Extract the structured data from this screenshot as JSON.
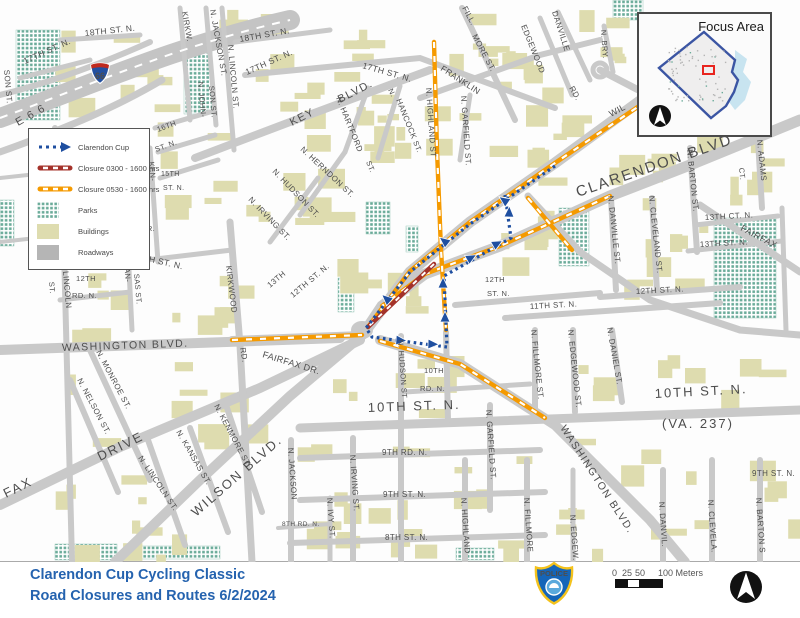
{
  "title_block": {
    "line1": "Clarendon Cup Cycling Classic",
    "line2": "Road Closures and Routes 6/2/2024"
  },
  "legend": {
    "items": [
      {
        "label": "Clarendon Cup"
      },
      {
        "label": "Closure 0300 - 1600 hrs"
      },
      {
        "label": "Closure 0530 - 1600 hrs"
      },
      {
        "label": "Parks"
      },
      {
        "label": "Buildings"
      },
      {
        "label": "Roadways"
      }
    ]
  },
  "inset": {
    "title": "Focus Area"
  },
  "scalebar": {
    "tick0": "0",
    "tick25": "25",
    "tick50": "50",
    "end_label": "100 Meters"
  },
  "badge": {
    "text": "POLICE"
  },
  "colors": {
    "route_blue": "#1f4fa0",
    "closure_0300": "#a4322a",
    "closure_0530": "#f59a00",
    "park_green": "#6aab99",
    "building_beige": "#dedcaf",
    "roadway_gray": "#b5b5b5",
    "title_blue": "#2563af"
  },
  "map": {
    "i66_shield": "66",
    "street_labels": [
      [
        "KIRKW.",
        182,
        12,
        80,
        8
      ],
      [
        "N. JACKSON ST.",
        210,
        10,
        80,
        8
      ],
      [
        "N. JOHN-",
        198,
        82,
        85,
        7.5
      ],
      [
        "SON ST.",
        209,
        86,
        85,
        7.5
      ],
      [
        "SON ST.",
        4,
        70,
        85,
        8
      ],
      [
        "18TH ST. N.",
        85,
        36,
        -6,
        8.5
      ],
      [
        "17TH ST. N.",
        25,
        64,
        -24,
        8.5
      ],
      [
        "18TH ST. N.",
        240,
        42,
        -10,
        8.5
      ],
      [
        "17TH ST. N.",
        247,
        75,
        -24,
        8.5
      ],
      [
        "17TH ST. N.",
        362,
        68,
        16,
        8.5
      ],
      [
        "N. LINCOLN ST.",
        228,
        45,
        85,
        8
      ],
      [
        "KEY",
        292,
        126,
        -27,
        11
      ],
      [
        "BLVD.",
        340,
        103,
        -27,
        11
      ],
      [
        "N. HARTFORD",
        336,
        98,
        68,
        8
      ],
      [
        "ST.",
        366,
        162,
        68,
        7.5
      ],
      [
        "N.",
        388,
        90,
        65,
        7.5
      ],
      [
        "HANCOCK",
        396,
        100,
        68,
        8
      ],
      [
        "ST.",
        413,
        142,
        68,
        7.5
      ],
      [
        "N. HIGHLAND ST",
        426,
        88,
        86,
        8
      ],
      [
        "N. GARFIELD ST.",
        461,
        96,
        86,
        8
      ],
      [
        "FRANKLIN",
        440,
        70,
        33,
        8.5
      ],
      [
        "RD.",
        569,
        88,
        60,
        8
      ],
      [
        "FILL.",
        462,
        8,
        62,
        8
      ],
      [
        "MORE ST.",
        472,
        36,
        62,
        8
      ],
      [
        "EDGEWOOD",
        521,
        26,
        68,
        8
      ],
      [
        "DANVILLE",
        552,
        12,
        72,
        8
      ],
      [
        "N. BRY.",
        601,
        30,
        86,
        7.5
      ],
      [
        "16TH",
        158,
        132,
        -20,
        7.5
      ],
      [
        "ST. N.",
        156,
        152,
        -20,
        7.5
      ],
      [
        "15TH",
        161,
        176,
        0,
        7
      ],
      [
        "ST. N.",
        163,
        190,
        0,
        7
      ],
      [
        "KEN-",
        149,
        162,
        85,
        7.5
      ],
      [
        "DR.",
        141,
        231,
        0,
        7.5
      ],
      [
        "13TH ST. N.",
        133,
        258,
        13,
        8.5
      ],
      [
        "KAN-",
        124,
        263,
        85,
        7.5
      ],
      [
        "SAS ST.",
        134,
        274,
        85,
        7.5
      ],
      [
        "12TH",
        76,
        281,
        0,
        7.5
      ],
      [
        "RD. N.",
        72,
        298,
        0,
        7.5
      ],
      [
        "N. LINCOLN",
        62,
        260,
        85,
        8
      ],
      [
        "ST.",
        49,
        282,
        85,
        7.5
      ],
      [
        "ROE ST.",
        54,
        172,
        85,
        8
      ],
      [
        "WASHINGTON BLVD.",
        62,
        351,
        -2,
        10.5
      ],
      [
        "KIRKWOOD",
        226,
        266,
        83,
        8
      ],
      [
        "RD.",
        240,
        348,
        80,
        8
      ],
      [
        "13TH",
        270,
        288,
        -40,
        8
      ],
      [
        "12TH ST. N.",
        293,
        298,
        -40,
        8
      ],
      [
        "FAIRFAX DR.",
        262,
        357,
        17,
        9
      ],
      [
        "N. HUDSON ST",
        398,
        340,
        86,
        7.5
      ],
      [
        "10TH",
        424,
        373,
        0,
        7.5
      ],
      [
        "RD. N.",
        420,
        391,
        0,
        7.5
      ],
      [
        "10TH ST. N.",
        368,
        412,
        -2,
        13
      ],
      [
        "10TH  ST.  N.",
        655,
        398,
        -3,
        13
      ],
      [
        "(VA.  237)",
        662,
        428,
        0,
        13
      ],
      [
        "9TH RD. N.",
        382,
        455,
        0,
        8
      ],
      [
        "9TH ST. N.",
        383,
        497,
        0,
        8
      ],
      [
        "8TH ST. N.",
        385,
        540,
        0,
        8
      ],
      [
        "8TH RD. N.",
        282,
        526,
        0,
        6.5
      ],
      [
        "N. JACKSON",
        288,
        448,
        86,
        8
      ],
      [
        "N. IRVING ST.",
        350,
        455,
        86,
        8
      ],
      [
        "N. IVY ST.",
        327,
        498,
        86,
        8
      ],
      [
        "N. GARFIELD ST.",
        486,
        410,
        86,
        8
      ],
      [
        "N. HIGHLAND",
        461,
        498,
        86,
        8
      ],
      [
        "N. FILLMORE ST.",
        531,
        330,
        84,
        8
      ],
      [
        "N. FILLMORE",
        524,
        498,
        86,
        8
      ],
      [
        "N. EDGEWOOD ST.",
        568,
        330,
        84,
        8
      ],
      [
        "N. EDGEW.",
        570,
        515,
        86,
        8
      ],
      [
        "N. DANIEL ST.",
        607,
        328,
        80,
        8
      ],
      [
        "WASHINGTON BLVD.",
        560,
        428,
        57,
        10.5
      ],
      [
        "N. DANVILLE ST.",
        608,
        196,
        84,
        8
      ],
      [
        "N. DANVIL.",
        659,
        502,
        86,
        8
      ],
      [
        "N. CLEVELAND ST.",
        649,
        196,
        84,
        8
      ],
      [
        "N. CLEVELA.",
        708,
        500,
        86,
        8
      ],
      [
        "N. BARTON ST.",
        687,
        150,
        84,
        8
      ],
      [
        "N. BARTON S",
        756,
        498,
        86,
        8
      ],
      [
        "CT.",
        739,
        168,
        84,
        7.5
      ],
      [
        "N. ADAMS",
        757,
        140,
        84,
        8
      ],
      [
        "13TH CT. N.",
        705,
        220,
        -3,
        8
      ],
      [
        "13TH ST. N.",
        700,
        247,
        -3,
        8
      ],
      [
        "FAIRFAX",
        740,
        230,
        28,
        9
      ],
      [
        "12TH ST. N.",
        636,
        294,
        -3,
        8
      ],
      [
        "11TH ST. N.",
        530,
        309,
        -3,
        8
      ],
      [
        "12TH",
        485,
        282,
        0,
        7.5
      ],
      [
        "ST. N.",
        487,
        296,
        0,
        7.5
      ],
      [
        "CLARENDON BLVD",
        578,
        197,
        -19,
        15
      ],
      [
        "WIL",
        611,
        117,
        -28,
        9
      ],
      [
        "WILSON BLVD.",
        196,
        517,
        -41,
        13
      ],
      [
        "DRIVE",
        100,
        461,
        -26,
        13
      ],
      [
        "FAX",
        6,
        498,
        -26,
        13
      ],
      [
        "N. MONROE ST.",
        96,
        352,
        62,
        8
      ],
      [
        "N. NELSON ST.",
        77,
        380,
        62,
        8
      ],
      [
        "N. LINCOLN ST.",
        138,
        458,
        56,
        8
      ],
      [
        "N. KANSAS ST.",
        176,
        432,
        60,
        8
      ],
      [
        "N. KENMORE ST.",
        214,
        406,
        62,
        8
      ],
      [
        "9TH ST. N.",
        752,
        476,
        0,
        8
      ],
      [
        "N. HERNDON ST.",
        300,
        150,
        43,
        8
      ],
      [
        "N. HUDSON ST.",
        272,
        172,
        46,
        8
      ],
      [
        "N. IRVING ST.",
        248,
        200,
        46,
        8
      ],
      [
        "E  6 6",
        18,
        126,
        -29,
        11
      ]
    ]
  }
}
